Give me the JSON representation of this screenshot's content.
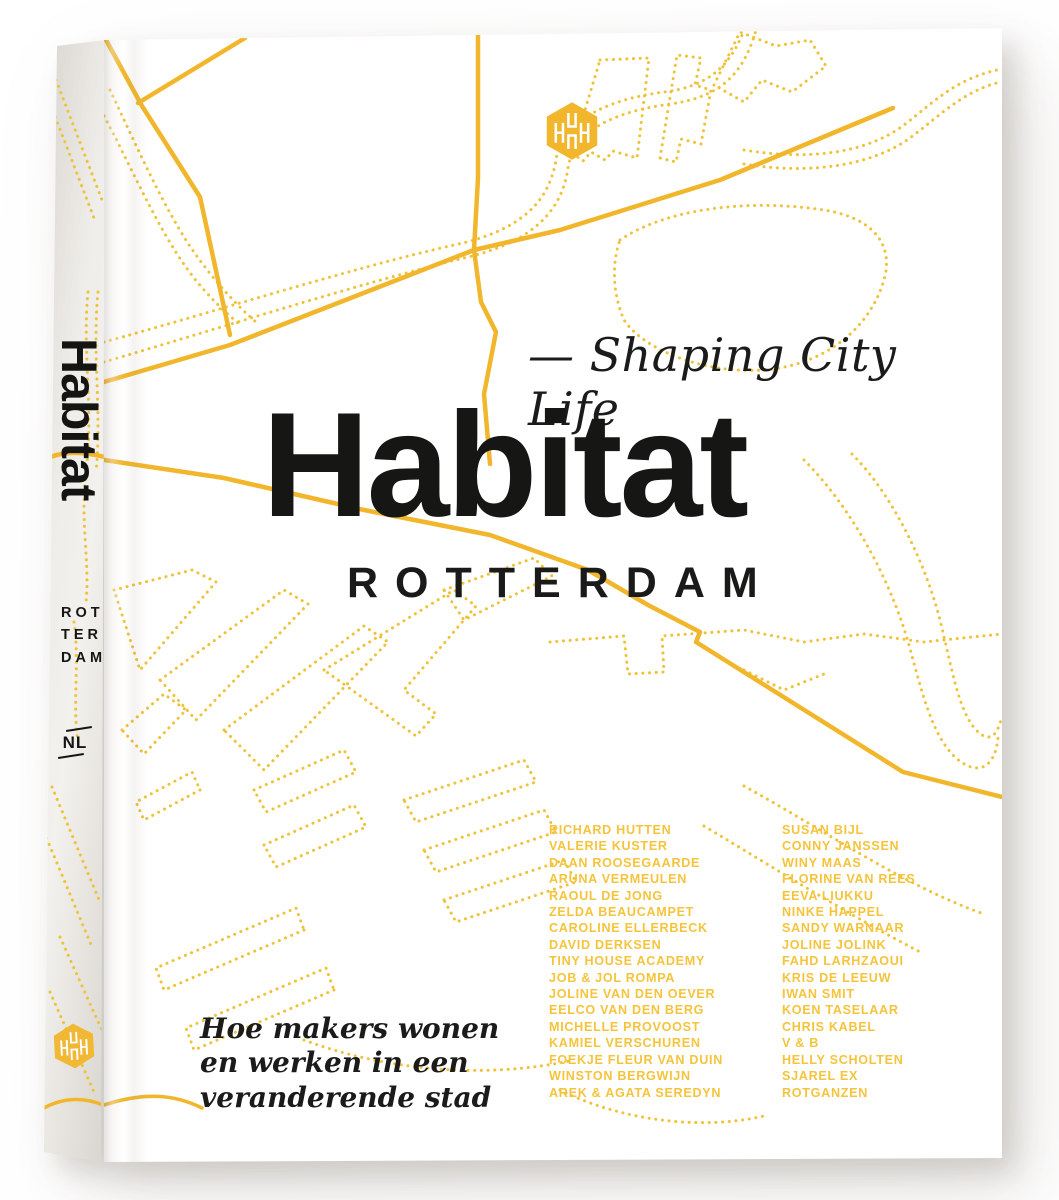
{
  "book": {
    "colors": {
      "map-solid": "#F1B62B",
      "map-dots": "#EFC23A",
      "names": "#F5C43C",
      "ink": "#1B1B19",
      "spine-light": "#EFEDE9",
      "spine-dark": "#D8D5CF",
      "cover": "#FFFFFF"
    },
    "icons": {
      "publisher_logo": "hexagon-monogram-logo",
      "map_background": "rotterdam-map-lines"
    },
    "spine": {
      "author_top": "PRISCILLA DE PUTTER",
      "title": "Habitat",
      "city_lines": [
        "ROT",
        "TER",
        "DAM"
      ],
      "country": "NL",
      "author_bottom": "NICOLINE RODENBURG"
    },
    "cover": {
      "tagline_en": "— Shaping City Life",
      "title": "Habitat",
      "subtitle": "ROTTERDAM",
      "contributors_left": [
        "RICHARD HUTTEN",
        "VALERIE KUSTER",
        "DAAN ROOSEGAARDE",
        "ARUNA VERMEULEN",
        "RAOUL DE JONG",
        "ZELDA BEAUCAMPET",
        "CAROLINE ELLERBECK",
        "DAVID DERKSEN",
        "TINY HOUSE ACADEMY",
        "JOB & JOL ROMPA",
        "JOLINE VAN DEN OEVER",
        "EELCO VAN DEN BERG",
        "MICHELLE PROVOOST",
        "KAMIEL VERSCHUREN",
        "FOEKJE FLEUR VAN DUIN",
        "WINSTON BERGWIJN",
        "AREK & AGATA SEREDYN"
      ],
      "contributors_right": [
        "SUSAN BIJL",
        "CONNY JANSSEN",
        "WINY MAAS",
        "FLORINE VAN REES",
        "EEVA LIUKKU",
        "NINKE HAPPEL",
        "SANDY WARNAAR",
        "JOLINE JOLINK",
        "FAHD LARHZAOUI",
        "KRIS DE LEEUW",
        "IWAN SMIT",
        "KOEN TASELAAR",
        "CHRIS KABEL",
        "V & B",
        "HELLY SCHOLTEN",
        "SJAREL EX",
        "ROTGANZEN"
      ],
      "tagline_nl_lines": [
        "Hoe makers wonen",
        "en werken in een",
        "veranderende stad"
      ]
    }
  }
}
